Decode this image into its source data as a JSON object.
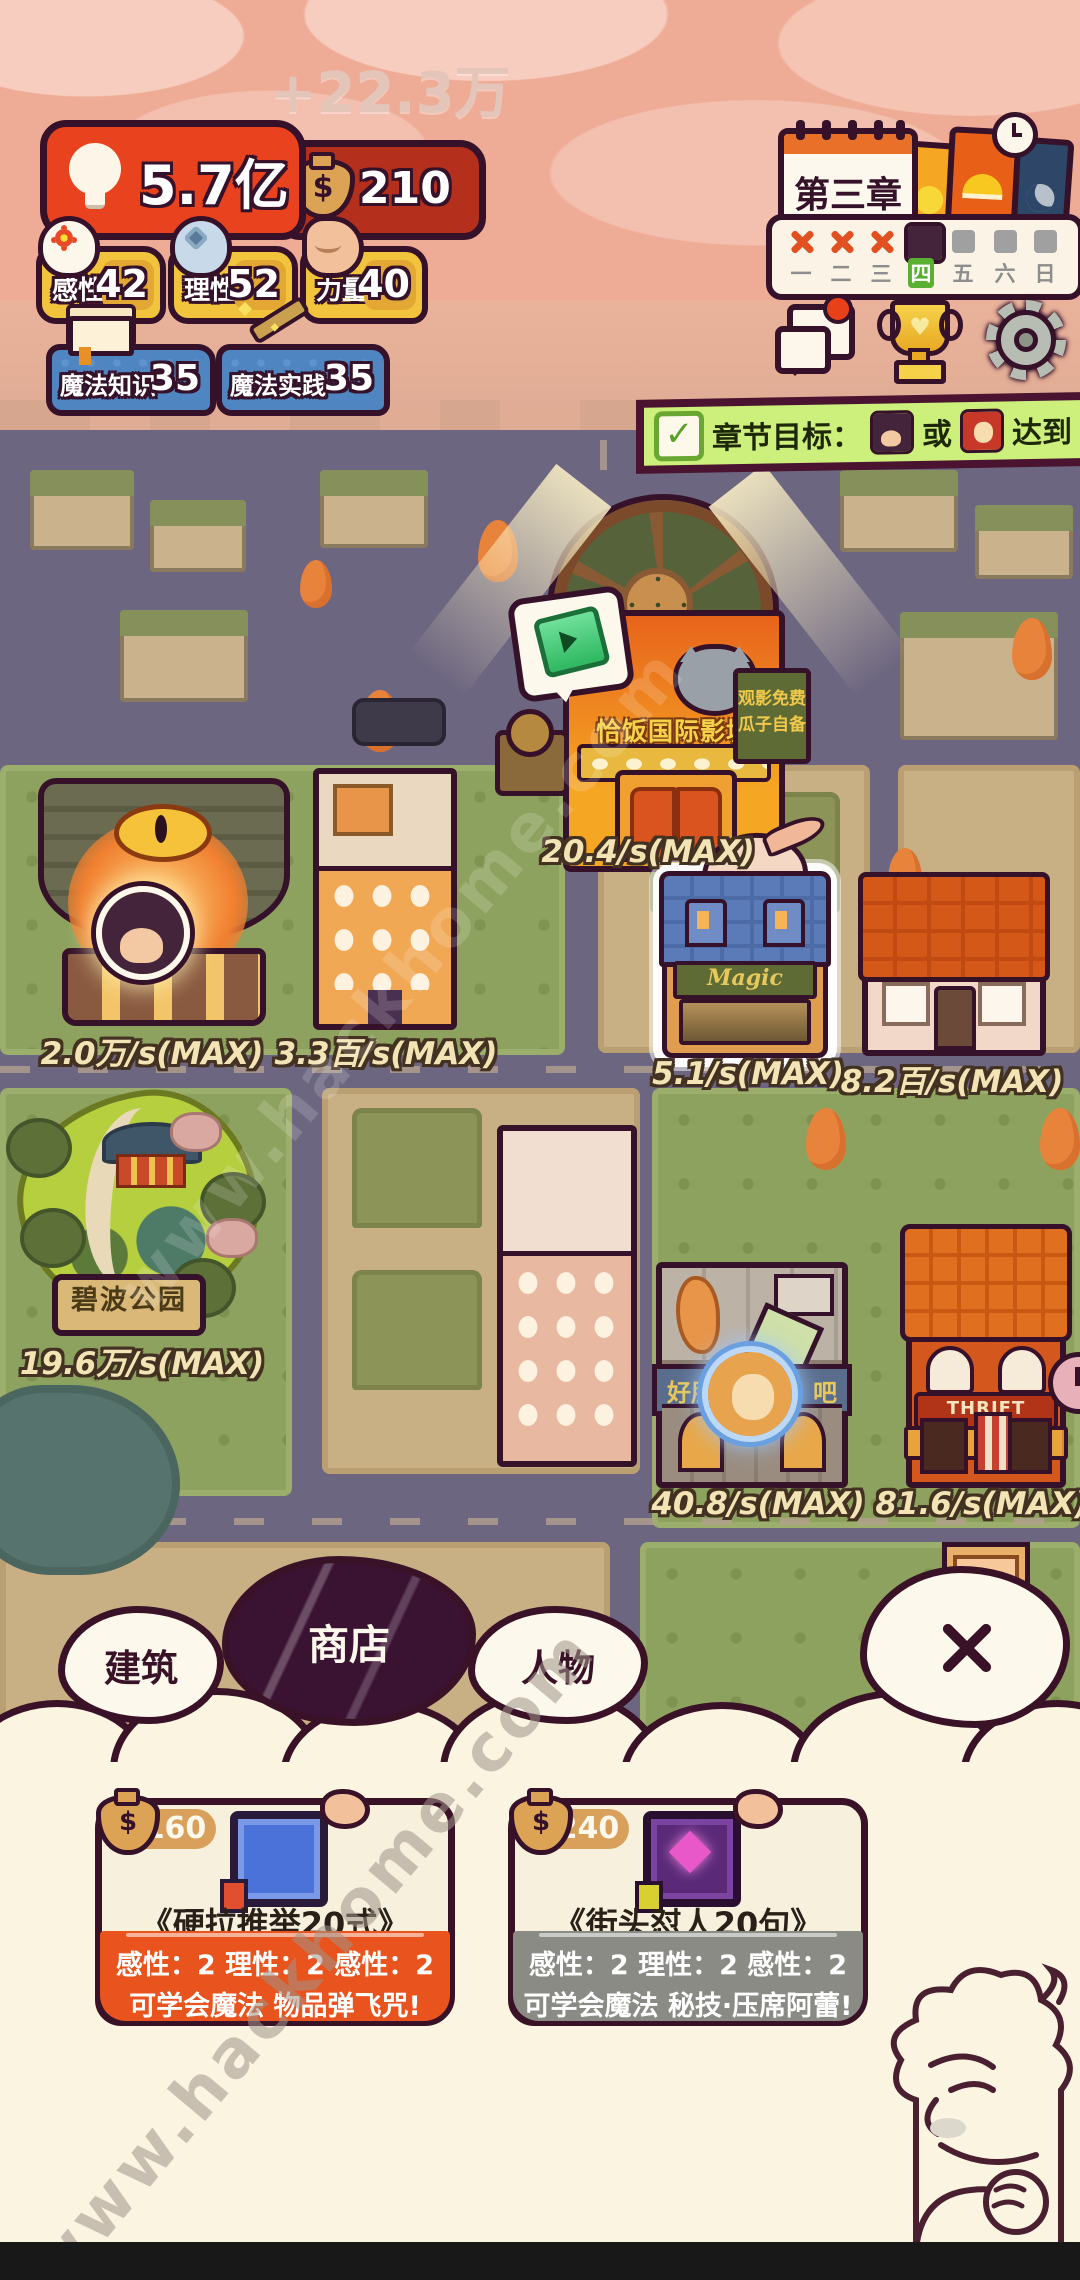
{
  "hud": {
    "floating_gain": "+22.3万",
    "energy_value": "5.7亿",
    "money_value": "210",
    "money_symbol": "$",
    "stats": [
      {
        "label": "感性",
        "value": "42"
      },
      {
        "label": "理性",
        "value": "52"
      },
      {
        "label": "力量",
        "value": "40"
      }
    ],
    "magic_stats": [
      {
        "label": "魔法知识",
        "value": "35"
      },
      {
        "label": "魔法实践",
        "value": "35"
      }
    ]
  },
  "calendar": {
    "chapter_title": "第三章",
    "days": [
      "一",
      "二",
      "三",
      "四",
      "五",
      "六",
      "日"
    ],
    "current_day": "四"
  },
  "goal_banner": {
    "check": "✓",
    "prefix": "章节目标：",
    "connector": "或",
    "suffix": "达到 3 好感"
  },
  "map": {
    "cinema": {
      "rate": "20.4/s(MAX)",
      "sign": "恰饭国际影城",
      "side_sign_top": "观影免费",
      "side_sign_bottom": "瓜子自备"
    },
    "shrine": {
      "rate": "2.0万/s(MAX)"
    },
    "apartment": {
      "rate": "3.3百/s(MAX)"
    },
    "magic_shop": {
      "rate": "5.1/s(MAX)",
      "sign": "Magic"
    },
    "house": {
      "rate": "8.2百/s(MAX)"
    },
    "park": {
      "rate": "19.6万/s(MAX)",
      "sign": "碧波公园"
    },
    "game_bar": {
      "rate": "40.8/s(MAX)",
      "sign_left": "好朋",
      "sign_right": "吧"
    },
    "thrift_shop": {
      "rate": "81.6/s(MAX)",
      "sign": "THRIFT SHOP"
    }
  },
  "panel": {
    "tabs": [
      {
        "label": "建筑",
        "selected": false
      },
      {
        "label": "商店",
        "selected": true
      },
      {
        "label": "人物",
        "selected": false
      }
    ],
    "items": [
      {
        "price": "160",
        "title": "《硬拉推举20式》",
        "stats_line": "感性：2 理性：2 感性：2",
        "effect_line": "可学会魔法 物品弹飞咒!",
        "accent": "#e8531e"
      },
      {
        "price": "240",
        "title": "《街头怼人20句》",
        "stats_line": "感性：2 理性：2 感性：2",
        "effect_line": "可学会魔法 秘技·压席阿蕾!",
        "accent": "#8b8b85"
      }
    ]
  },
  "watermark": "www.hackhome.com",
  "colors": {
    "hud_red": "#e8421f",
    "hud_red_dark": "#b5301c",
    "stat_gold": "#f2c33d",
    "magic_blue": "#4f86c2",
    "goal_green": "#cdf07c",
    "tab_selected": "#3a1232",
    "panel_cream": "#fbf4e1"
  }
}
